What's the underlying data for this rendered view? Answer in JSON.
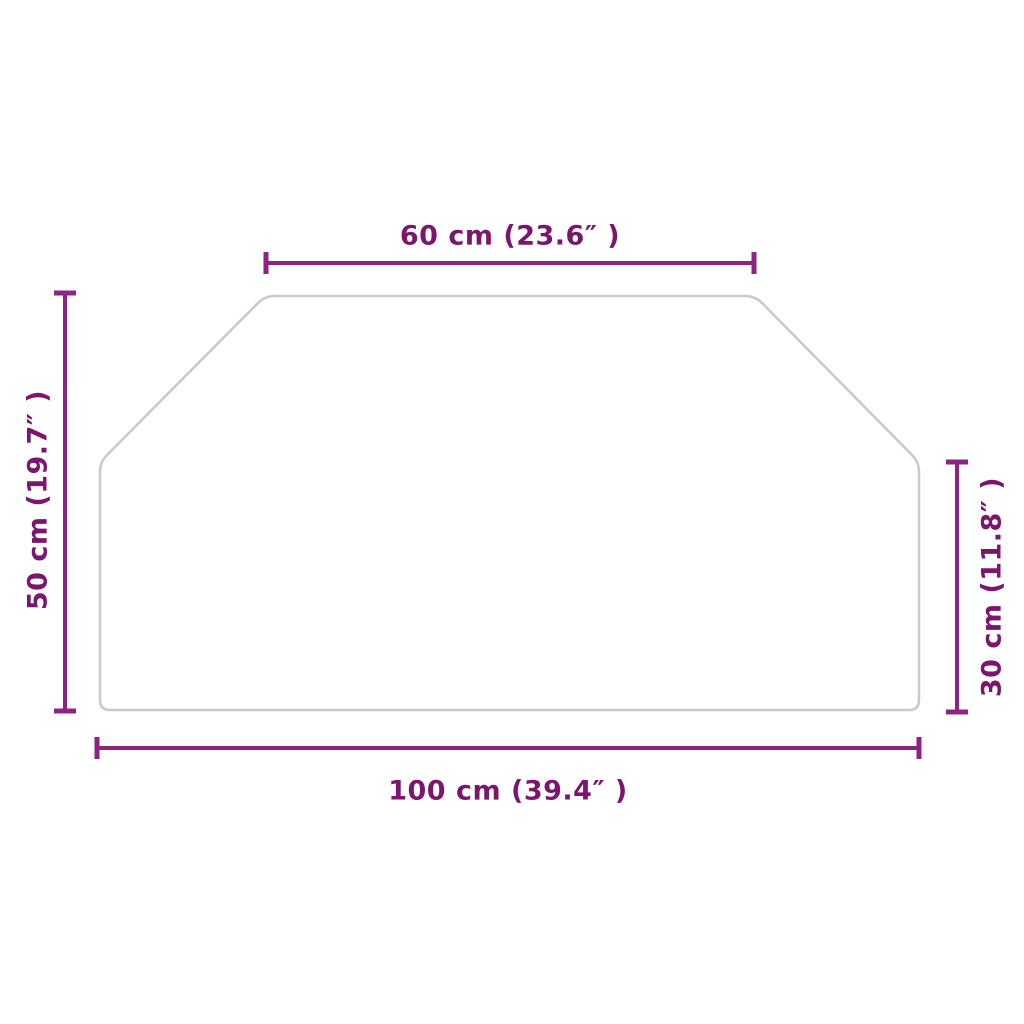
{
  "diagram": {
    "type": "product-dimension-diagram",
    "shape": "hexagonal-glass-panel",
    "colors": {
      "background": "#ffffff",
      "shape_outline": "#c9c9c9",
      "dimension_line": "#8d2383",
      "label_text": "#7c156e"
    },
    "dimensions": {
      "top_width": {
        "label": "60 cm (23.6″ )",
        "value_cm": 60,
        "value_in": 23.6
      },
      "bottom_width": {
        "label": "100 cm (39.4″ )",
        "value_cm": 100,
        "value_in": 39.4
      },
      "left_height": {
        "label": "50 cm (19.7″ )",
        "value_cm": 50,
        "value_in": 19.7
      },
      "right_height": {
        "label": "30 cm (11.8″ )",
        "value_cm": 30,
        "value_in": 11.8
      }
    }
  }
}
